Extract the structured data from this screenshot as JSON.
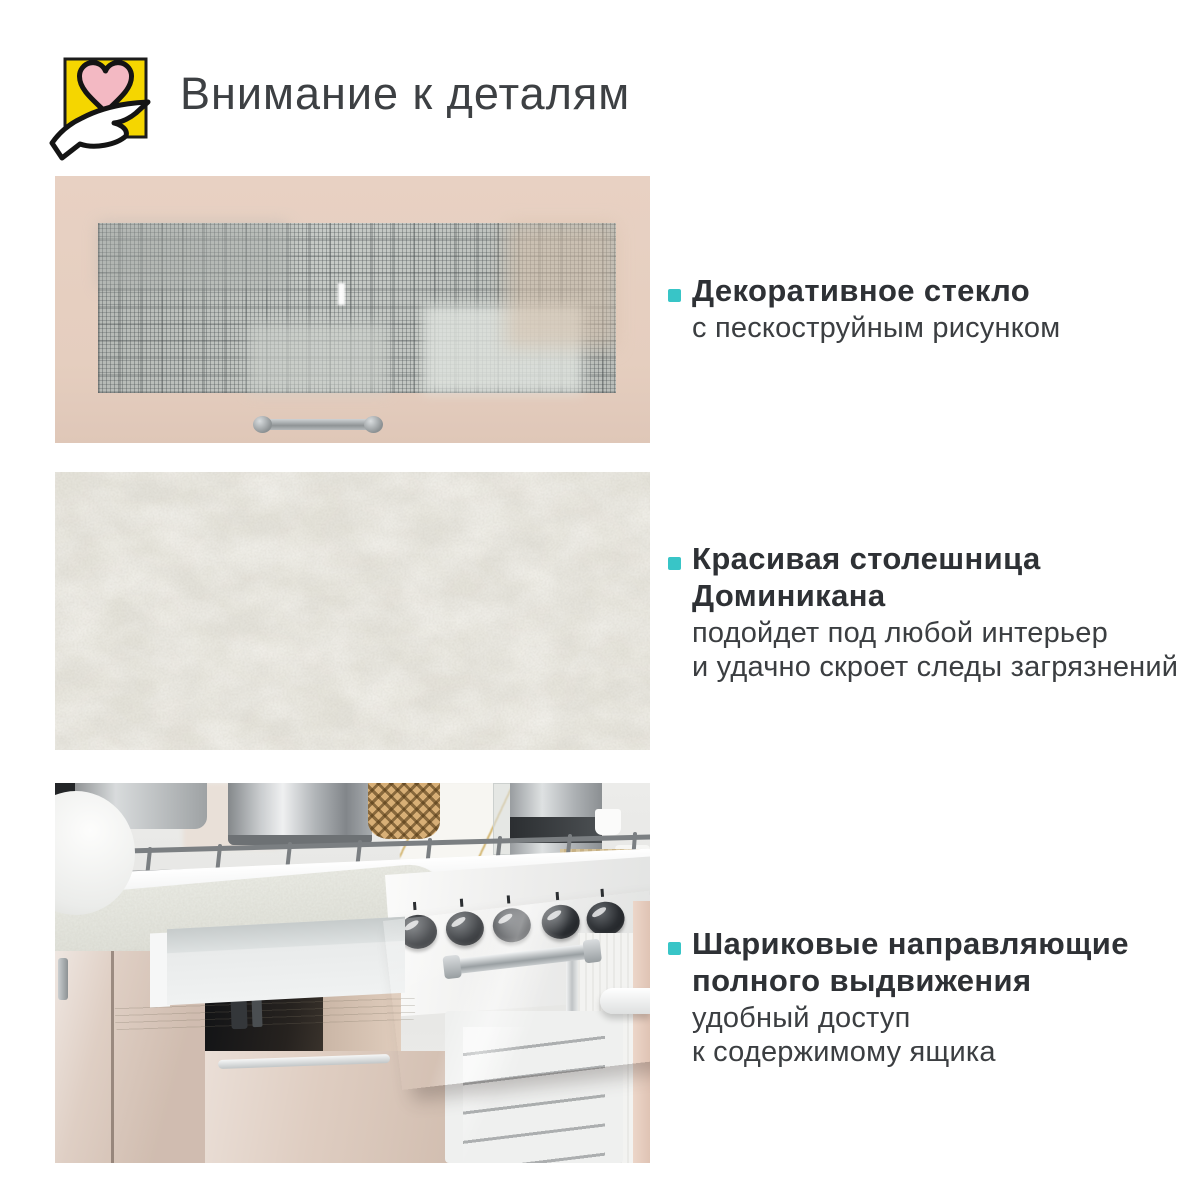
{
  "header": {
    "title": "Внимание к деталям",
    "icon": "hand-holding-heart-icon"
  },
  "palette": {
    "accent_teal": "#38C5C7",
    "icon_yellow": "#F5D600",
    "heart_pink": "#F2B8C2",
    "facade_beige": "#E6CFC0",
    "text_dark": "#2E3135"
  },
  "features": [
    {
      "photo": "glass-cabinet-door-photo",
      "title_lines": [
        "Декоративное стекло"
      ],
      "desc_lines": [
        "с пескоструйным рисунком"
      ]
    },
    {
      "photo": "dominikana-countertop-photo",
      "title_lines": [
        "Красивая столешница",
        "Доминикана"
      ],
      "desc_lines": [
        "подойдет под любой интерьер",
        "и удачно скроет следы загрязнений"
      ]
    },
    {
      "photo": "open-drawer-ball-slides-photo",
      "title_lines": [
        "Шариковые направляющие",
        "полного выдвижения"
      ],
      "desc_lines": [
        "удобный доступ",
        "к содержимому ящика"
      ]
    }
  ]
}
